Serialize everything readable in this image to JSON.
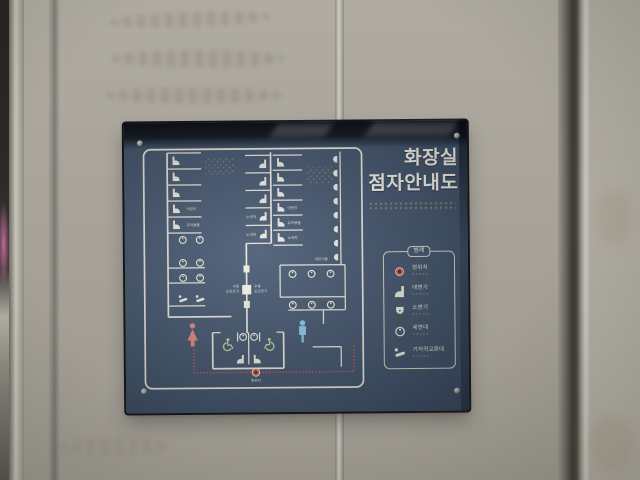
{
  "sign": {
    "title": {
      "line1": "화장실",
      "line2": "점자안내도"
    },
    "legend": {
      "title": "범례",
      "items": [
        {
          "label": "현위치"
        },
        {
          "label": "대변기"
        },
        {
          "label": "소변기"
        },
        {
          "label": "세면대"
        },
        {
          "label": "기저귀교환대"
        }
      ]
    },
    "floorplan": {
      "labels": {
        "child": "어린이",
        "infant": "유아용품",
        "elderly": "노약자",
        "child_urinal": "어린이용",
        "dryer_line1": "수동",
        "dryer_line2": "손건조기",
        "current_location": "현위치"
      },
      "counts": {
        "toilet_stalls_left": 5,
        "toilet_stalls_mid_left": 5,
        "toilet_stalls_mid_right": 6,
        "urinals": 8,
        "washbasins_left": 6,
        "washbasins_right": 6,
        "accessible_stalls": 2,
        "diaper_stations": 2,
        "hand_dryers": 3
      }
    },
    "colors": {
      "panel": "#46576d",
      "lines": "#e9e6da",
      "female_symbol": "#e08a80",
      "male_symbol": "#8fc8e8",
      "wheelchair_symbol": "#b9d69c",
      "route_dots": "#d4595a",
      "current_location": "#c95b50",
      "braille_dots": "#a79b80",
      "wall": "#a7a39a"
    }
  }
}
